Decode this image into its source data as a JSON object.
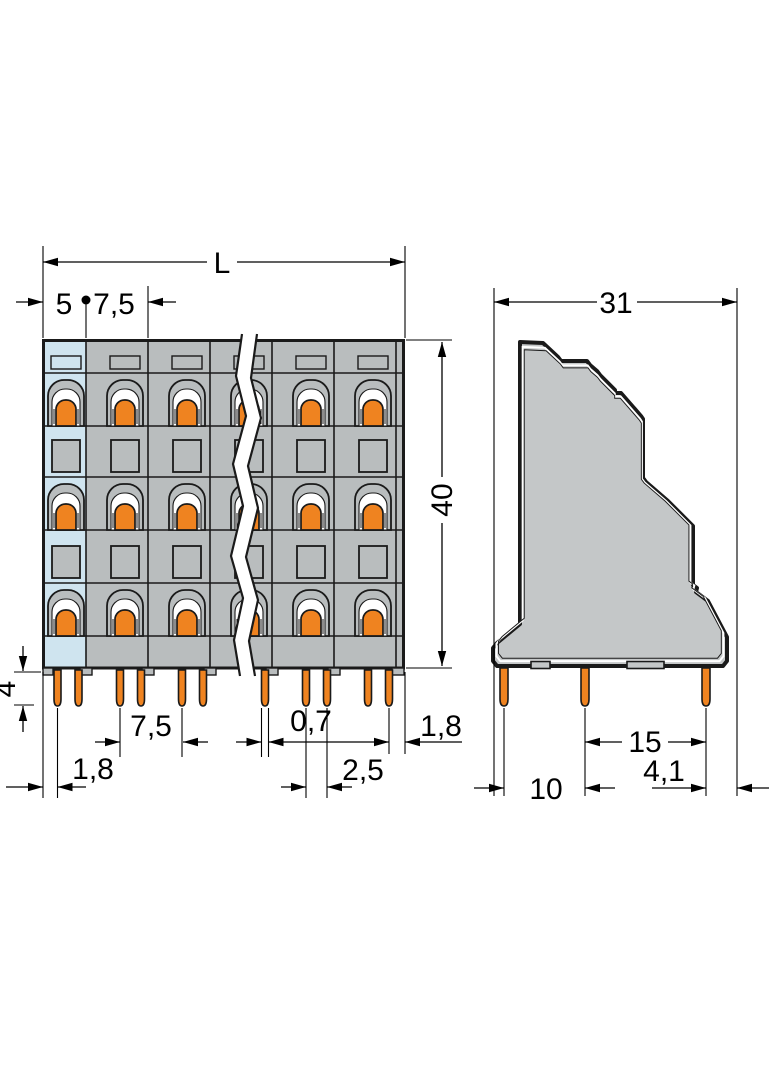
{
  "front_view": {
    "dim_overall_length": "L",
    "dim_end_section_width": "5",
    "dim_pole_pitch_top": "7,5",
    "dim_body_height": "40",
    "dim_pin_protrusion": "4",
    "dim_pole_pitch_bottom": "7,5",
    "dim_pin_width": "0,7",
    "dim_first_pin_offset": "1,8",
    "dim_last_pin_offset": "1,8",
    "dim_pin_pair_spacing": "2,5"
  },
  "side_view": {
    "dim_overall_depth": "31",
    "dim_pin_span_rear": "15",
    "dim_last_pin_to_edge": "4,1",
    "dim_pin_span_front": "10"
  },
  "colors": {
    "housing_gray": "#b9bdbe",
    "side_housing_gray": "#c4c7c8",
    "end_plate_blue": "#cfe4ef",
    "clamp_orange": "#ef8320",
    "outline_dark": "#1a1a1a",
    "dimension_black": "#000000",
    "white": "#ffffff"
  }
}
